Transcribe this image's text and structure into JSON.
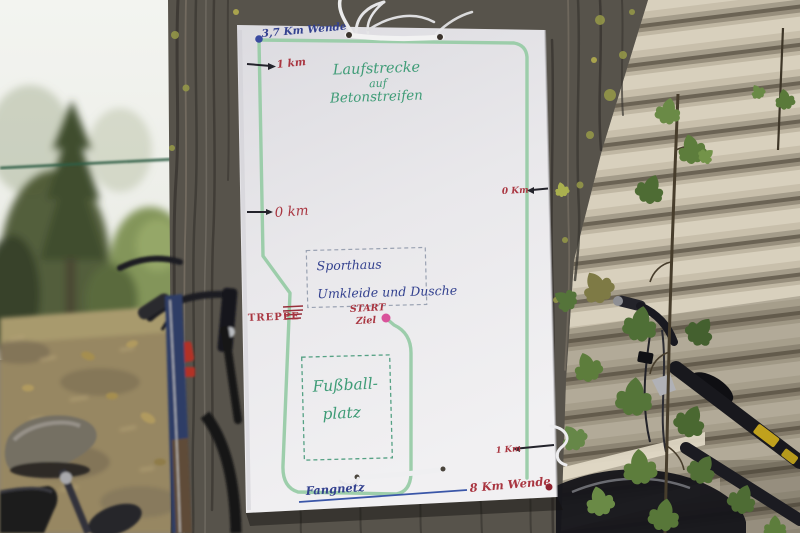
{
  "sign": {
    "title": {
      "line1": "Laufstrecke",
      "line2": "auf",
      "line3": "Betonstreifen"
    },
    "course_markers": {
      "top_turn": "3,7 Km Wende",
      "left_1km": "1 km",
      "left_0km": "0 km",
      "right_0km": "0 Km",
      "right_1km": "1 Km",
      "bottom_turn": "8 Km Wende"
    },
    "places": {
      "sporthaus_line1": "Sporthaus",
      "sporthaus_line2": "Umkleide und Dusche",
      "fussball_line1": "Fußball-",
      "fussball_line2": "platz",
      "fangnetz": "Fangnetz",
      "treppe": "TREPPE",
      "start": "START",
      "ziel": "Ziel"
    },
    "colors": {
      "paper": "#eae9ec",
      "route_green": "#98cba7",
      "title_green": "#3f9c77",
      "marker_red": "#a93540",
      "label_blue": "#33418f",
      "start_dot": "#d9539b",
      "turn_dot_blue": "#3a4aa0",
      "turn_dot_red": "#8f2330"
    }
  }
}
